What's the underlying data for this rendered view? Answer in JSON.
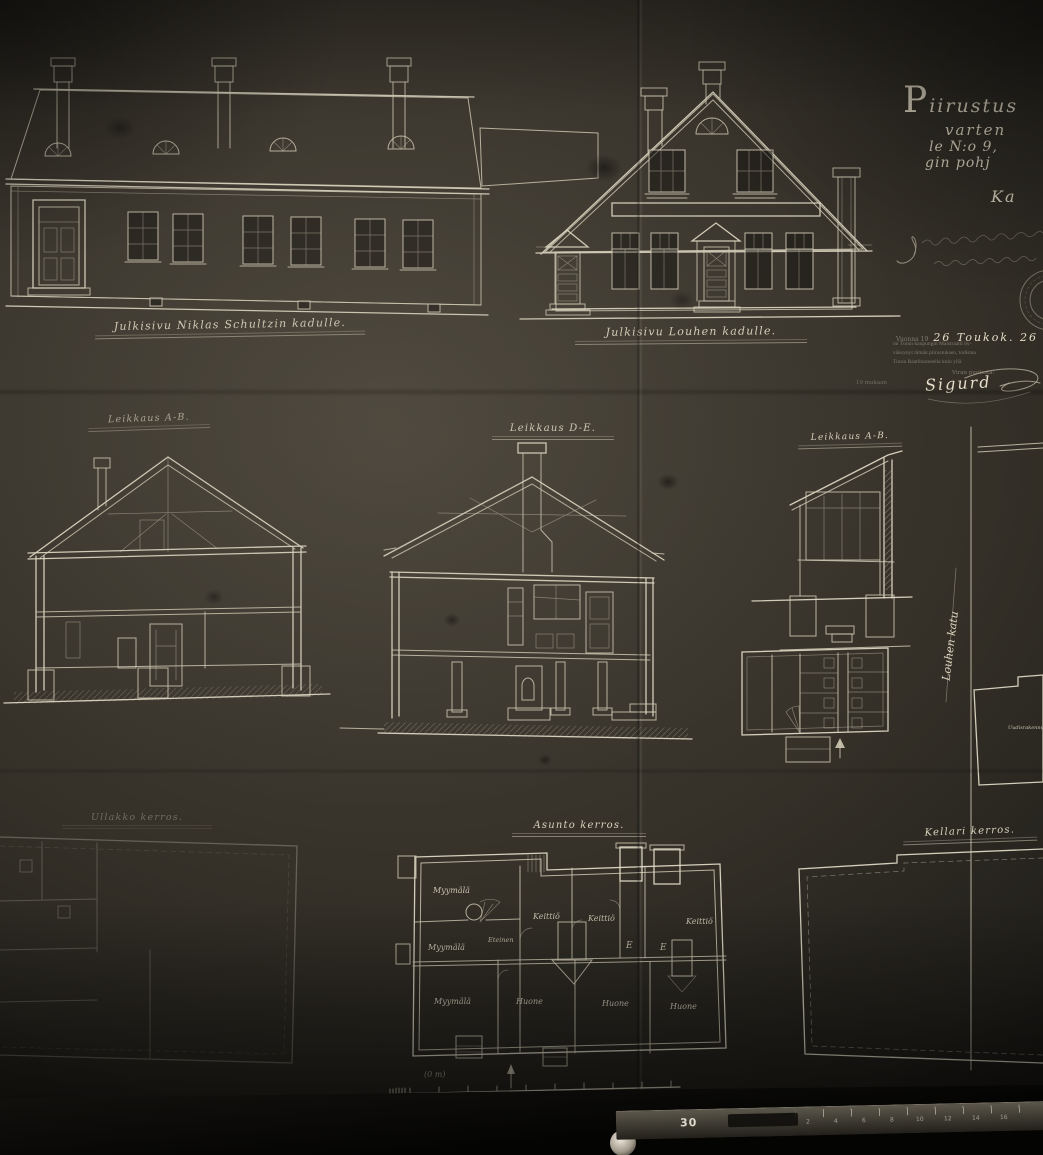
{
  "artifact": {
    "type": "architectural blueprint photograph",
    "ink_color": "#d6cfba",
    "paper_color": "#35312a"
  },
  "title_block": {
    "line1": "Piirustus",
    "line2": "varten",
    "line3": "le N:o 9,",
    "line4": "gin pohj",
    "line5": "Ka"
  },
  "approval": {
    "date_prefix": "Vuonna 19",
    "date_script": "26  Toukok.  26",
    "date_suffix": "p:nä",
    "clerk_lines": [
      "on Turun kaupungin Maistraatti hy-",
      "väksynyt tämän piirustuksen, todistaa",
      "Turun Raatihuoneella kuin yllä"
    ],
    "by_label": "Viran puolesta:",
    "signature": "Sigurd",
    "margin_note": "19 mukaan"
  },
  "elevations": {
    "left_label": "Julkisivu Niklas Schultzin kadulle.",
    "center_label": "Julkisivu Louhen kadulle."
  },
  "sections": {
    "left_label": "Leikkaus A-B.",
    "center_label": "Leikkaus D-E.",
    "right_label": "Leikkaus A-B."
  },
  "plans": {
    "left_label": "Ullakko kerros.",
    "center_label": "Asunto kerros.",
    "right_label": "Kellari kerros.",
    "rooms": {
      "shop1": "Myymälä",
      "shop2": "Myymälä",
      "shop3": "Myymälä",
      "hall": "Eteinen",
      "kitchen1": "Keittiö",
      "kitchen2": "Keittiö",
      "kitchen3": "Keittiö",
      "room1": "Huone",
      "room2": "Huone",
      "room3": "Huone",
      "mark1": "E",
      "mark2": "E"
    }
  },
  "site_plan": {
    "street_label": "Louhen katu",
    "building_label": "Uudisrakennus"
  },
  "scale_bar": {
    "note": "(0 m)"
  },
  "ruler": {
    "label": "30",
    "ticks": [
      "2",
      "4",
      "6",
      "8",
      "10",
      "12",
      "14",
      "16"
    ]
  }
}
